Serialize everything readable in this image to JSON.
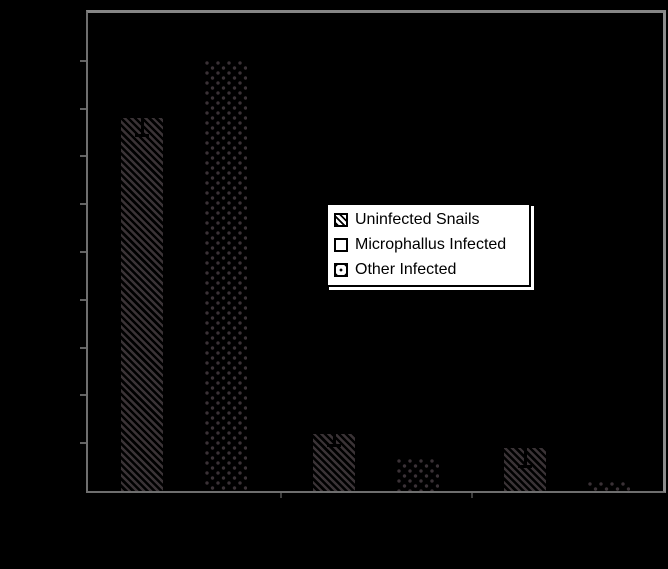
{
  "canvas": {
    "background_color": "#000000",
    "note": "figure text and value/category axis labels are drawn in black and are invisible against the black background; only the white legend box is readable"
  },
  "plot_frame": {
    "top_right_color": "#8a8a8a",
    "left_bottom_color": "#6e6e6e",
    "tick_color": "#626262",
    "y_tick_count": 9
  },
  "legend": {
    "background": "#ffffff",
    "border_color": "#000000",
    "text_color": "#000000",
    "items": [
      {
        "label": "Uninfected Snails",
        "swatch": "diagonal-hatch"
      },
      {
        "label": "Microphallus Infected",
        "swatch": "empty"
      },
      {
        "label": "Other Infected",
        "swatch": "dots"
      }
    ]
  },
  "chart_data": {
    "type": "bar",
    "title": "",
    "xlabel": "",
    "ylabel": "",
    "categories": [
      "Group 1",
      "Group 2",
      "Group 3"
    ],
    "categories_note": "three category groups; their tick labels are not visible (black on black)",
    "series": [
      {
        "name": "Uninfected Snails",
        "pattern": "diagonal-hatch",
        "values_axis_fraction": [
          0.78,
          0.12,
          0.09
        ],
        "error_whisker_fraction": [
          0.04,
          0.028,
          0.042
        ]
      },
      {
        "name": "Microphallus Infected",
        "pattern": "empty",
        "values_axis_fraction": [
          0,
          0,
          0
        ]
      },
      {
        "name": "Other Infected",
        "pattern": "dots",
        "values_axis_fraction": [
          0.9,
          0.066,
          0.019
        ]
      }
    ],
    "ylim": [
      0,
      1
    ],
    "y_tick_step": 0.1,
    "grid": false,
    "legend_position": "center-right",
    "bar_pattern_color": "#3a3336",
    "error_bar_color": "#000000"
  }
}
